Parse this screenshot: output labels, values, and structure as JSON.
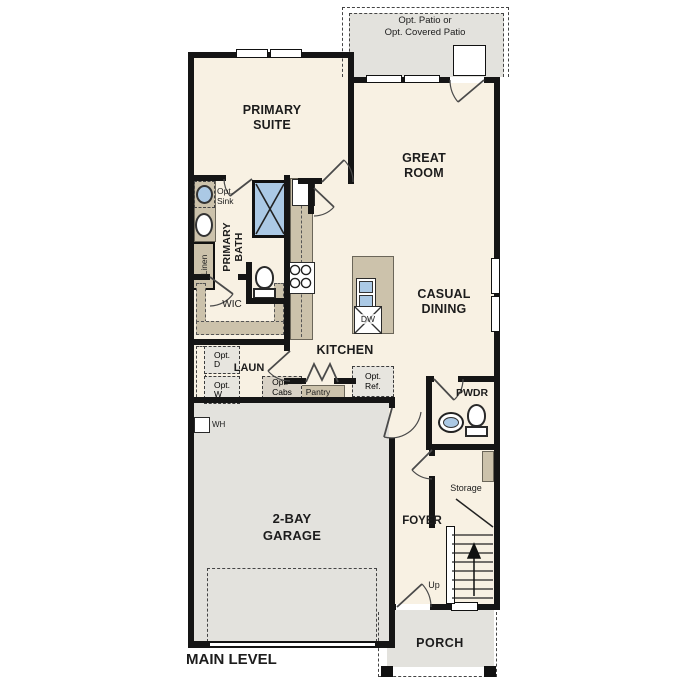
{
  "plan": {
    "title": "MAIN LEVEL",
    "patio": {
      "line1": "Opt. Patio or",
      "line2": "Opt. Covered Patio"
    },
    "primary_suite": {
      "line1": "PRIMARY",
      "line2": "SUITE"
    },
    "great_room": {
      "line1": "GREAT",
      "line2": "ROOM"
    },
    "primary_bath": {
      "line1": "PRIMARY",
      "line2": "BATH"
    },
    "opt_sink": {
      "line1": "Opt.",
      "line2": "Sink"
    },
    "linen": {
      "label": "Linen"
    },
    "wic": {
      "label": "WIC"
    },
    "kitchen": {
      "label": "KITCHEN"
    },
    "casual_dining": {
      "line1": "CASUAL",
      "line2": "DINING"
    },
    "laundry": {
      "label": "LAUN"
    },
    "opt_dryer": {
      "line1": "Opt.",
      "line2": "D"
    },
    "opt_washer": {
      "line1": "Opt.",
      "line2": "W"
    },
    "opt_cabs": {
      "line1": "Opt.",
      "line2": "Cabs"
    },
    "pantry": {
      "label": "Pantry"
    },
    "opt_ref": {
      "line1": "Opt.",
      "line2": "Ref."
    },
    "dishwasher": {
      "label": "DW"
    },
    "powder": {
      "label": "PWDR"
    },
    "storage": {
      "label": "Storage"
    },
    "stairs": {
      "up_label": "Up"
    },
    "foyer": {
      "label": "FOYER"
    },
    "garage": {
      "line1": "2-BAY",
      "line2": "GARAGE"
    },
    "water_heater": {
      "label": "WH"
    },
    "porch": {
      "label": "PORCH"
    }
  },
  "colors": {
    "floor": "#f8f1e3",
    "exterior_concrete": "#e3e2dd",
    "casework_tan": "#ccc2ab",
    "fixture_blue": "#abc9e5",
    "wall": "#151515"
  }
}
